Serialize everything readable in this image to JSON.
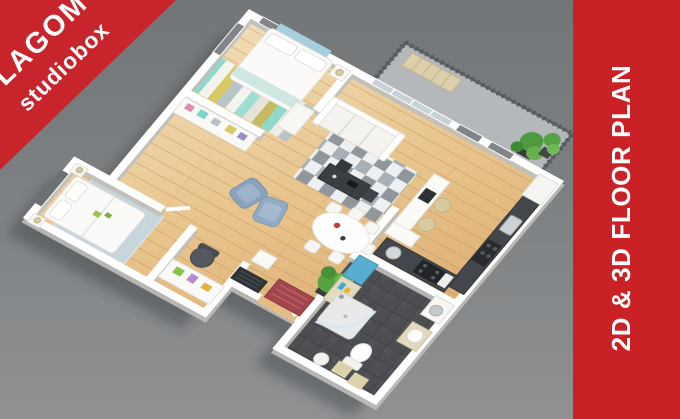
{
  "branding": {
    "logo_line1": "LAGOM",
    "logo_line2": "studiobox"
  },
  "side_banner": {
    "text": "2D & 3D FLOOR PLAN"
  },
  "scene": {
    "description_elements": {
      "ribbon": "red corner ribbon top-left",
      "banner": "red vertical banner right edge",
      "render": "isometric 3D apartment floor plan on gray backdrop"
    }
  },
  "colors": {
    "ribbon_red": "#c8242b",
    "banner_red": "#ca2127",
    "text_white": "#ffffff",
    "background_gray_top": "#737678",
    "background_gray_bottom": "#8f9193",
    "wall_white": "#ffffff",
    "wood_floor_light": "#f3debb",
    "wood_floor_dark": "#d8a368",
    "bathroom_tile_gray": "#4c4e51",
    "balcony_concrete": "#b5b8bb",
    "kitchen_counter_dark": "#43464a",
    "rug_stripe_teal": "#8fd8cc",
    "rug_stripe_yellow": "#d9c868",
    "master_rug_blue": "#c7d5dc",
    "armchair_blue": "#8aa3bd",
    "doormat_red": "#a3454e",
    "plant_green": "#55a344",
    "headboard_art_blue": "#a6cede"
  }
}
